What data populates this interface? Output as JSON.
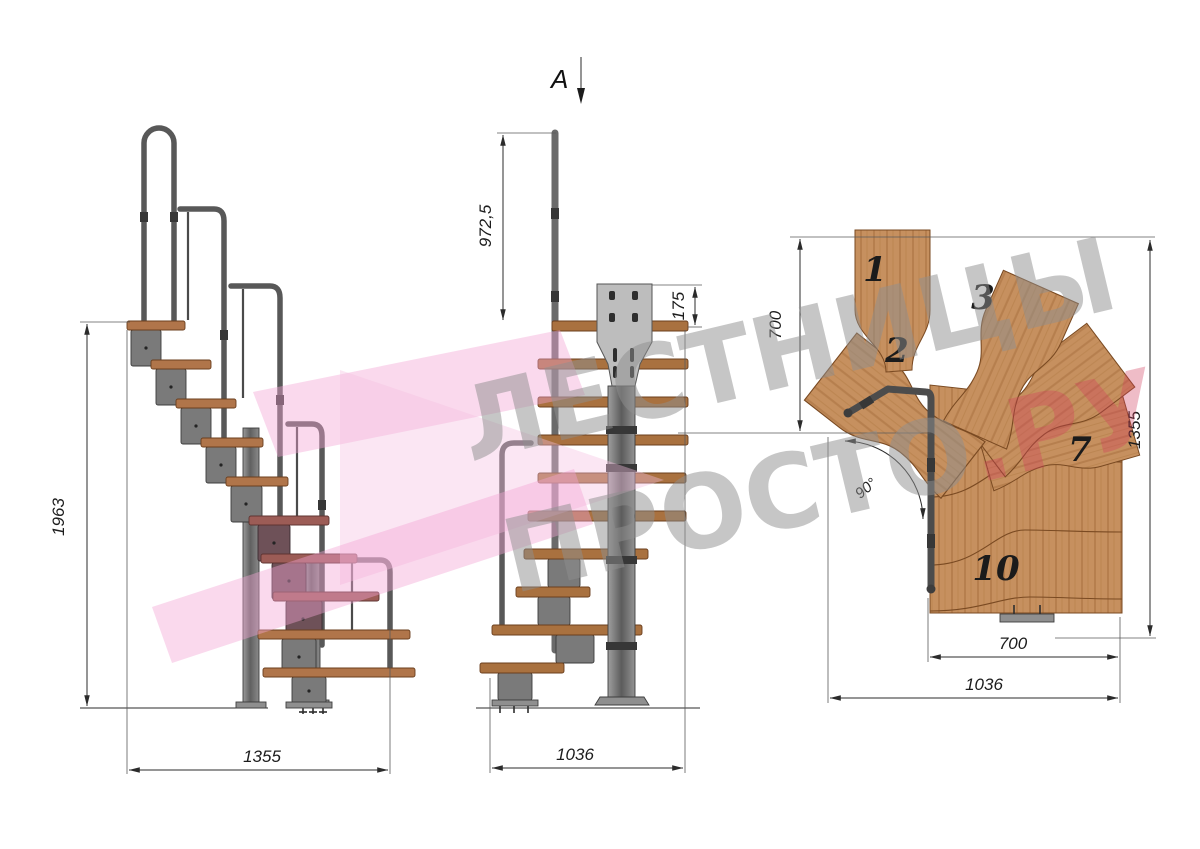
{
  "drawing": {
    "section_marker": "A",
    "watermark": {
      "line1": "ЛЕСТНИЦЫ",
      "line2": "ПРОСТО",
      "suffix": ".РУ"
    },
    "side_view": {
      "height_total": "1963",
      "length_total": "1355"
    },
    "front_view": {
      "handrail_height": "972,5",
      "bracket_height": "175",
      "width_total": "1036"
    },
    "plan_view": {
      "upper_flight_width": "700",
      "plan_depth": "1355",
      "tread_length": "700",
      "plan_width": "1036",
      "turn_angle": "90°",
      "step_numbers": [
        "1",
        "2",
        "3",
        "7",
        "10"
      ]
    },
    "colors": {
      "wood": "#c6905f",
      "wood_grain": "#7a4a22",
      "metal": "#7a7a7a",
      "watermark_gray": "#8f8f8f",
      "watermark_red": "#d23b5b",
      "watermark_pink": "#f2a4d5"
    }
  }
}
